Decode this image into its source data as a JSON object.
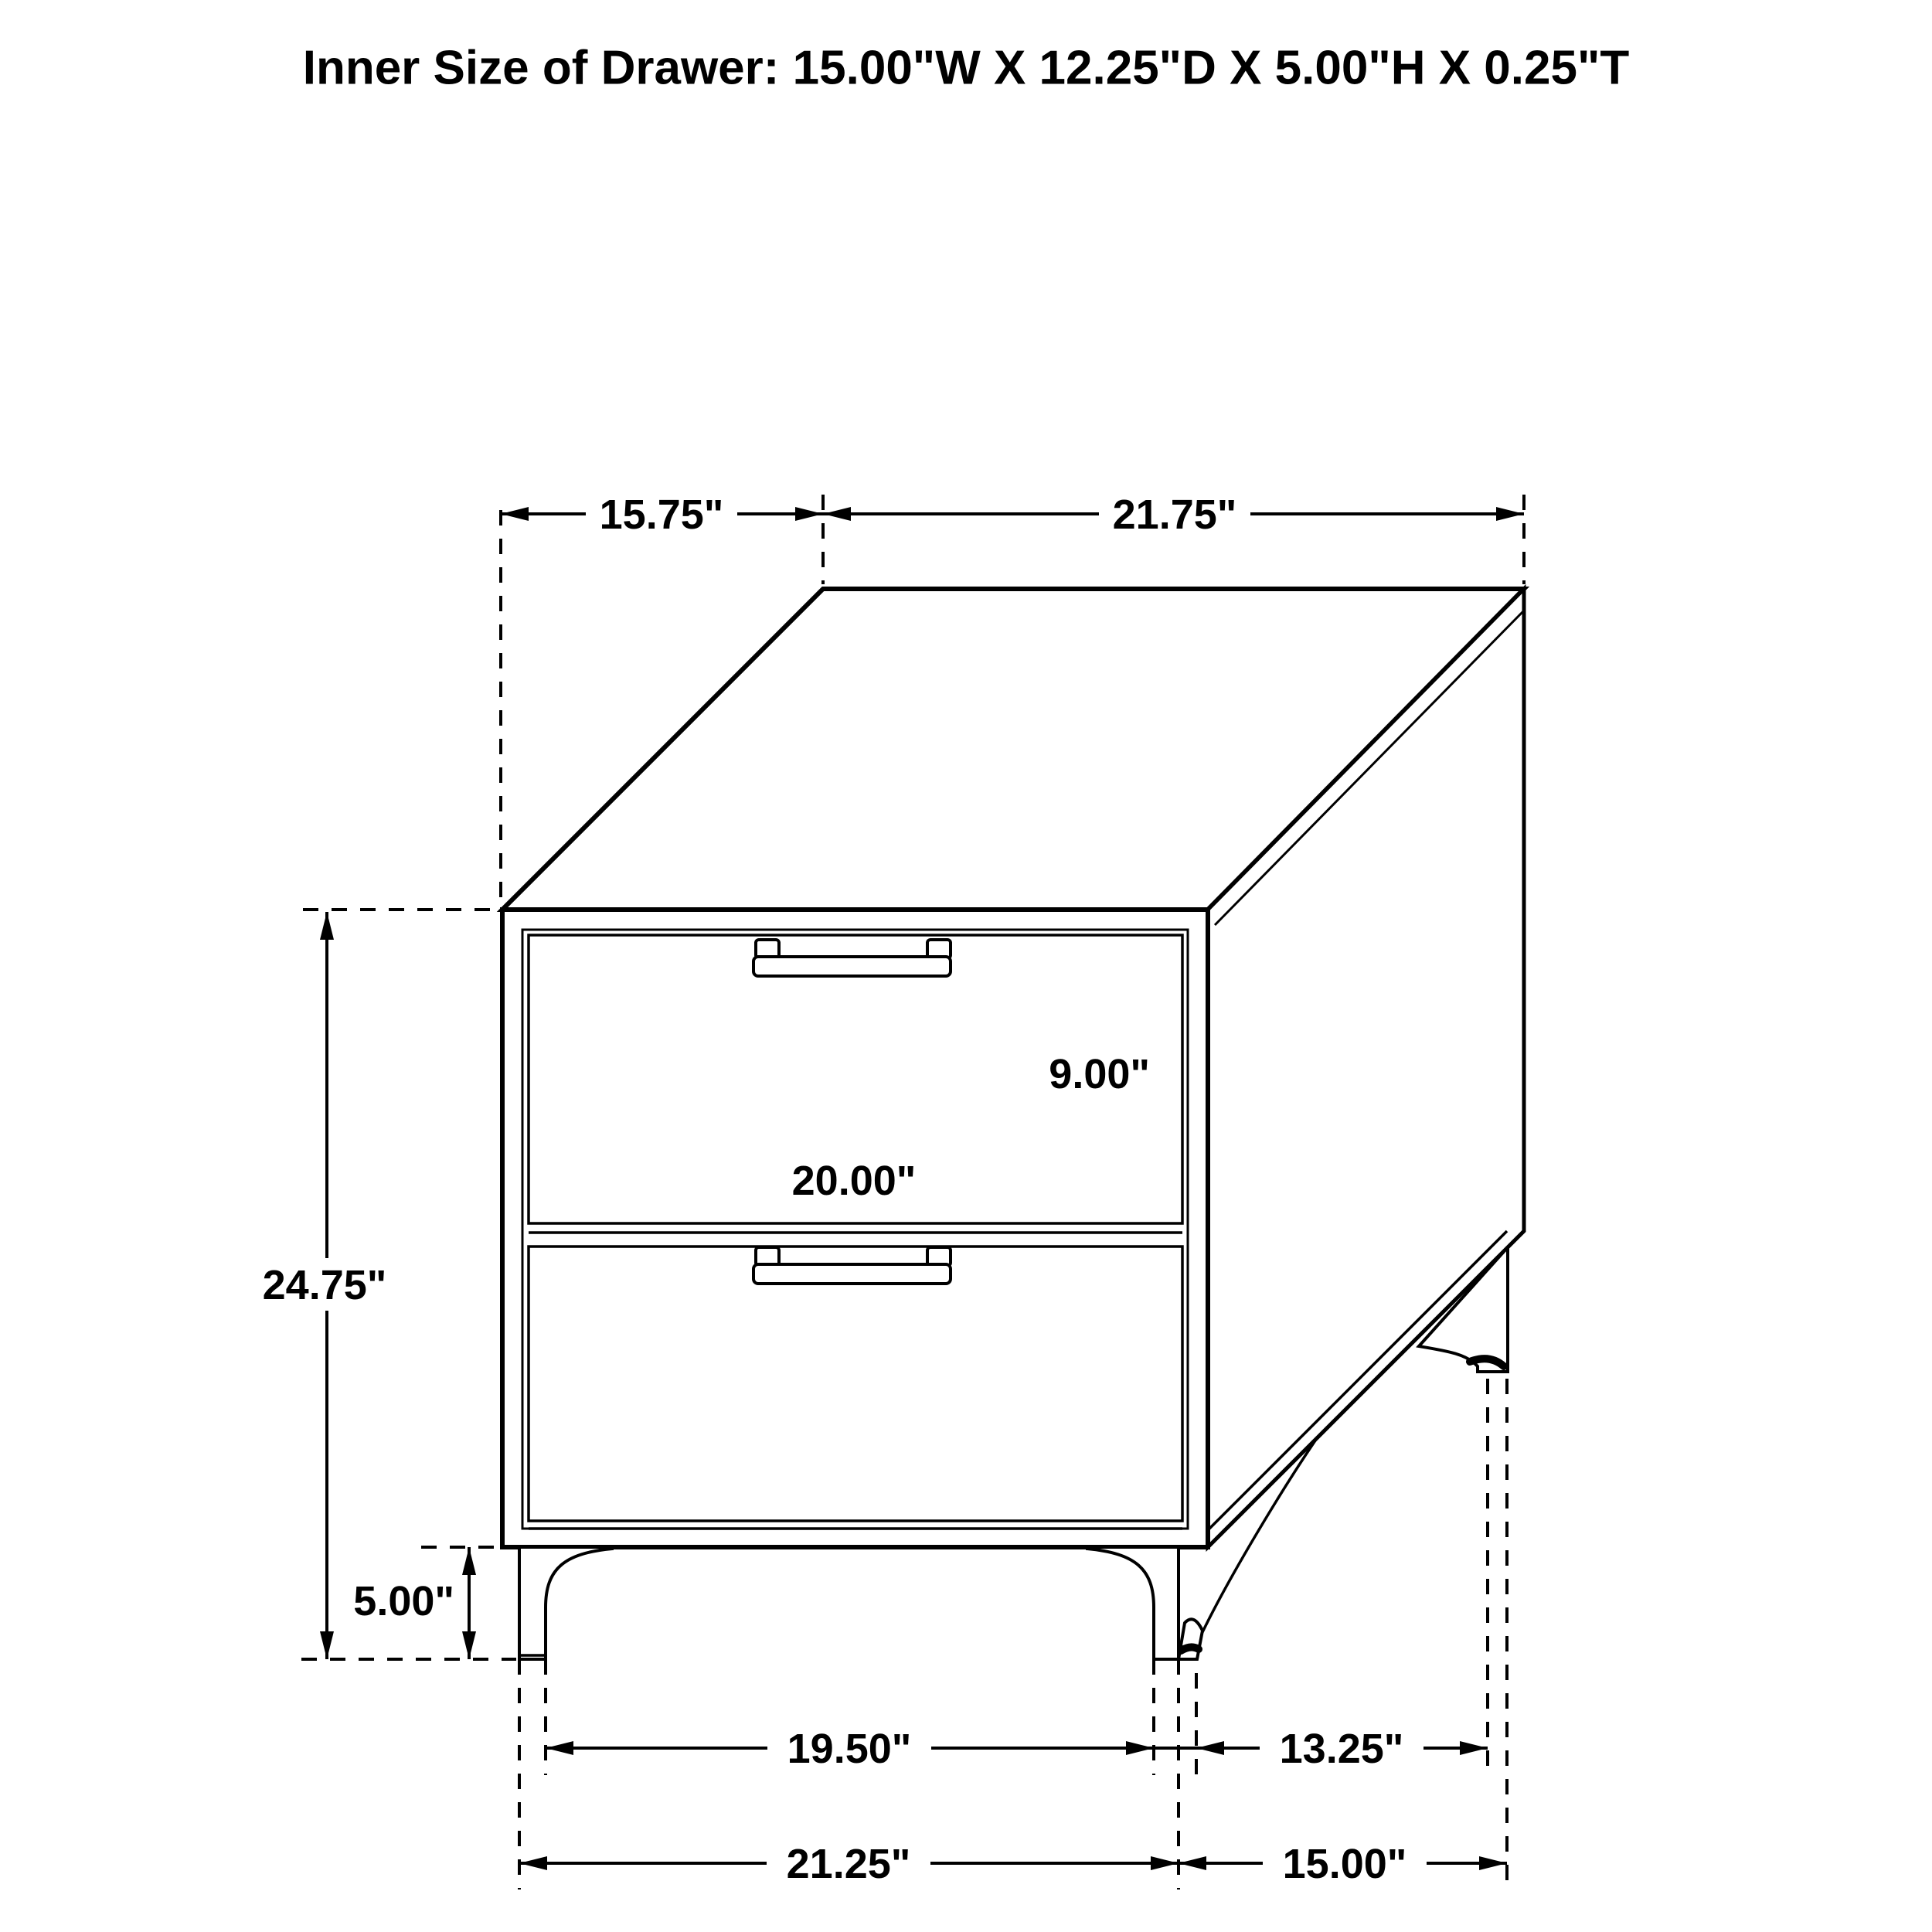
{
  "labels": {
    "title": "Inner Size of Drawer: 15.00\"W X 12.25\"D X 5.00\"H X 0.25\"T",
    "top_depth": "15.75\"",
    "top_width": "21.75\"",
    "overall_height": "24.75\"",
    "leg_height": "5.00\"",
    "drawer_front_height": "9.00\"",
    "drawer_front_width": "20.00\"",
    "front_feet_inner_span": "19.50\"",
    "side_feet_span": "13.25\"",
    "front_feet_outer_span": "21.25\"",
    "side_depth_span": "15.00\""
  },
  "colors": {
    "line": "#000000",
    "background": "#ffffff"
  }
}
